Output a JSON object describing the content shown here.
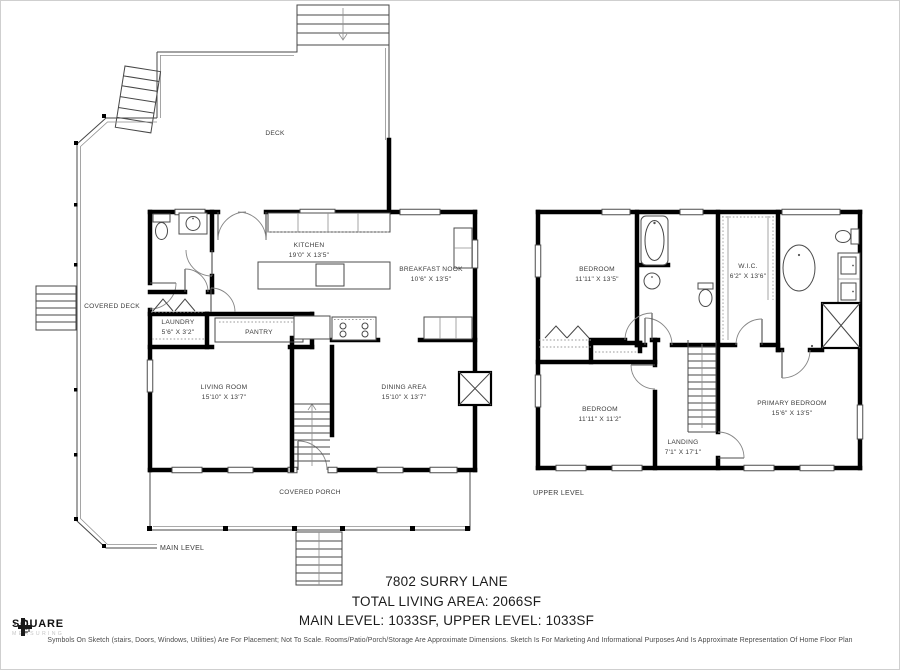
{
  "colors": {
    "wall": "#000000",
    "line": "#474747",
    "background": "#ffffff"
  },
  "title_block": {
    "address": "7802 SURRY LANE",
    "total": "TOTAL LIVING AREA: 2066SF",
    "levels": "MAIN LEVEL: 1033SF, UPPER LEVEL: 1033SF"
  },
  "disclaimer": "Symbols On Sketch (stairs, Doors, Windows, Utilities) Are For Placement; Not To Scale. Rooms/Patio/Porch/Storage Are Approximate Dimensions. Sketch Is For Marketing And Informational Purposes And Is Approximate Representation Of Home Floor Plan",
  "logo": {
    "brand": "SQUARE",
    "sub": "MEASURING"
  },
  "main_level": {
    "label": "MAIN LEVEL",
    "areas": {
      "deck": {
        "name": "DECK"
      },
      "covered_deck": {
        "name": "COVERED DECK"
      },
      "covered_porch": {
        "name": "COVERED PORCH"
      },
      "kitchen": {
        "name": "KITCHEN",
        "dims": "19'0\" X 13'5\""
      },
      "breakfast_nook": {
        "name": "BREAKFAST NOOK",
        "dims": "10'6\" X 13'5\""
      },
      "laundry": {
        "name": "LAUNDRY",
        "dims": "5'6\" X 3'2\""
      },
      "pantry": {
        "name": "PANTRY"
      },
      "living_room": {
        "name": "LIVING ROOM",
        "dims": "15'10\" X 13'7\""
      },
      "dining_area": {
        "name": "DINING AREA",
        "dims": "15'10\" X 13'7\""
      }
    }
  },
  "upper_level": {
    "label": "UPPER LEVEL",
    "areas": {
      "bedroom_1": {
        "name": "BEDROOM",
        "dims": "11'11\" X 13'5\""
      },
      "wic": {
        "name": "W.I.C.",
        "dims": "6'2\" X 13'6\""
      },
      "bedroom_2": {
        "name": "BEDROOM",
        "dims": "11'11\" X 11'2\""
      },
      "landing": {
        "name": "LANDING",
        "dims": "7'1\" X 17'1\""
      },
      "primary_bedroom": {
        "name": "PRIMARY BEDROOM",
        "dims": "15'6\" X 13'5\""
      }
    }
  }
}
